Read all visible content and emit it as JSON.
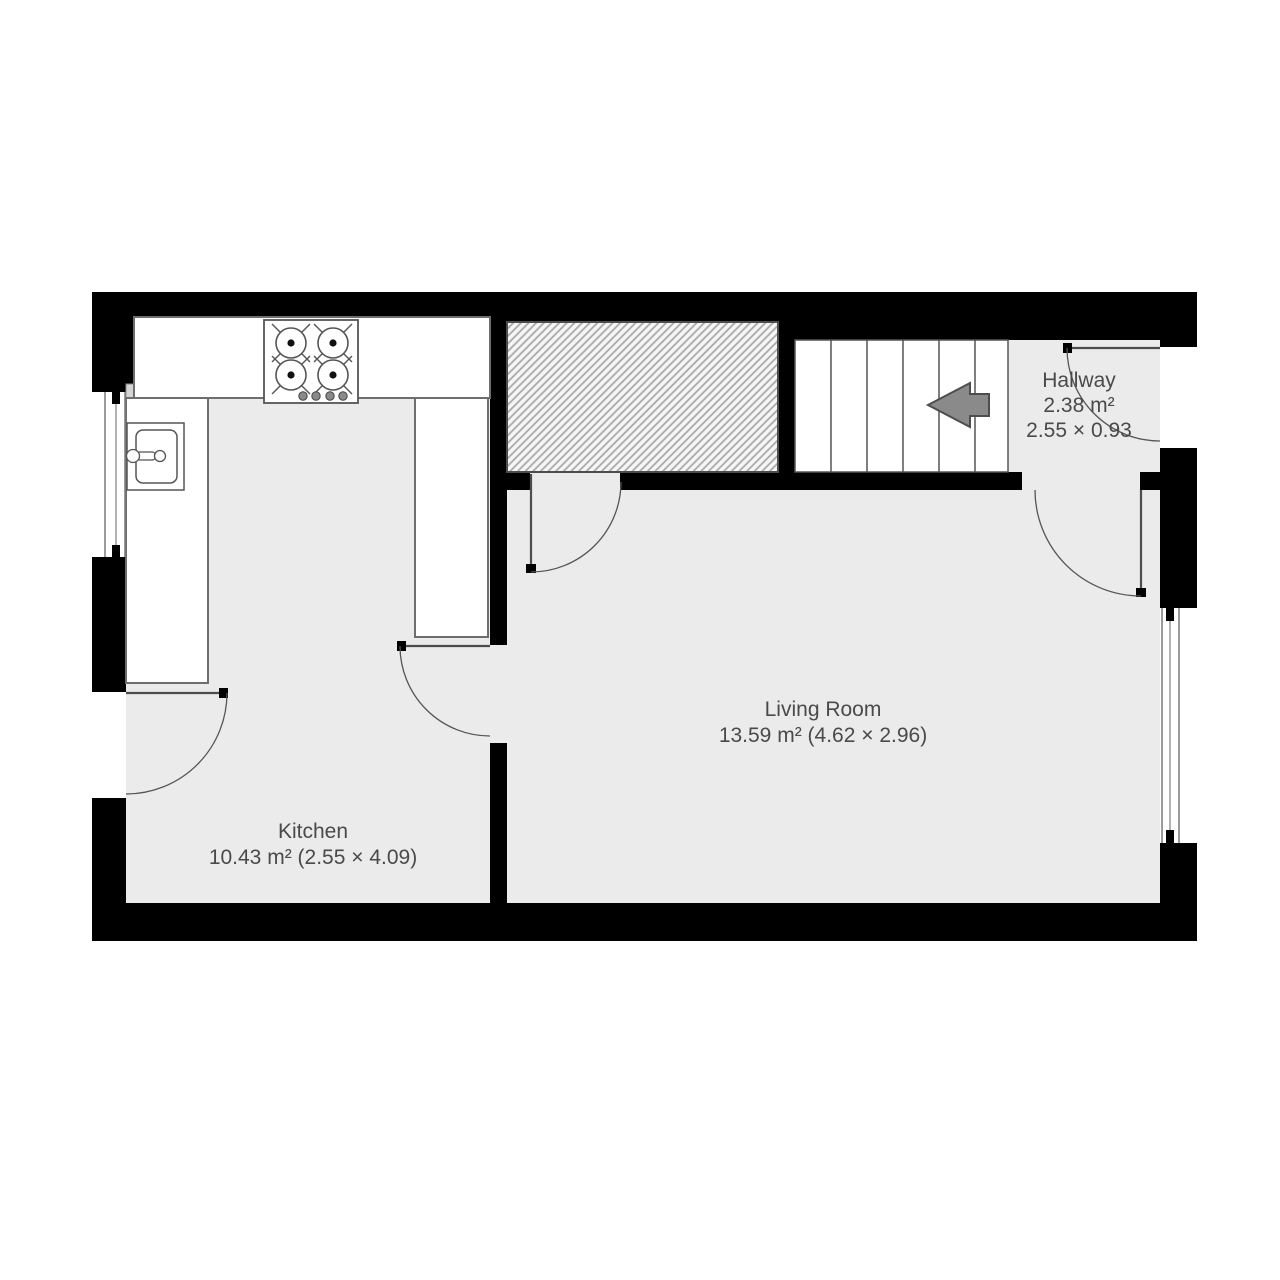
{
  "floor_plan": {
    "rooms": {
      "kitchen": {
        "name": "Kitchen",
        "details": "10.43 m² (2.55 × 4.09)"
      },
      "living_room": {
        "name": "Living Room",
        "details": "13.59 m² (4.62 × 2.96)"
      },
      "hallway": {
        "name": "Hallway",
        "area": "2.38 m²",
        "dimensions": "2.55 × 0.93"
      }
    },
    "fixtures": {
      "stove": "4-burner hob",
      "sink": "kitchen sink",
      "stairs": "staircase with down direction arrow pointing left",
      "hatched_area": "void / under-stair area"
    },
    "colors": {
      "wall": "#000000",
      "floor": "#ebebeb",
      "fixture_fill": "#ffffff",
      "fixture_outline": "#666666",
      "hatch_background": "#f6f6f6",
      "hatch_line": "#a9a9a9",
      "arrow_fill": "#8a8a8a",
      "arrow_outline": "#4d4d4d",
      "label_text": "#4a4a4a"
    }
  }
}
